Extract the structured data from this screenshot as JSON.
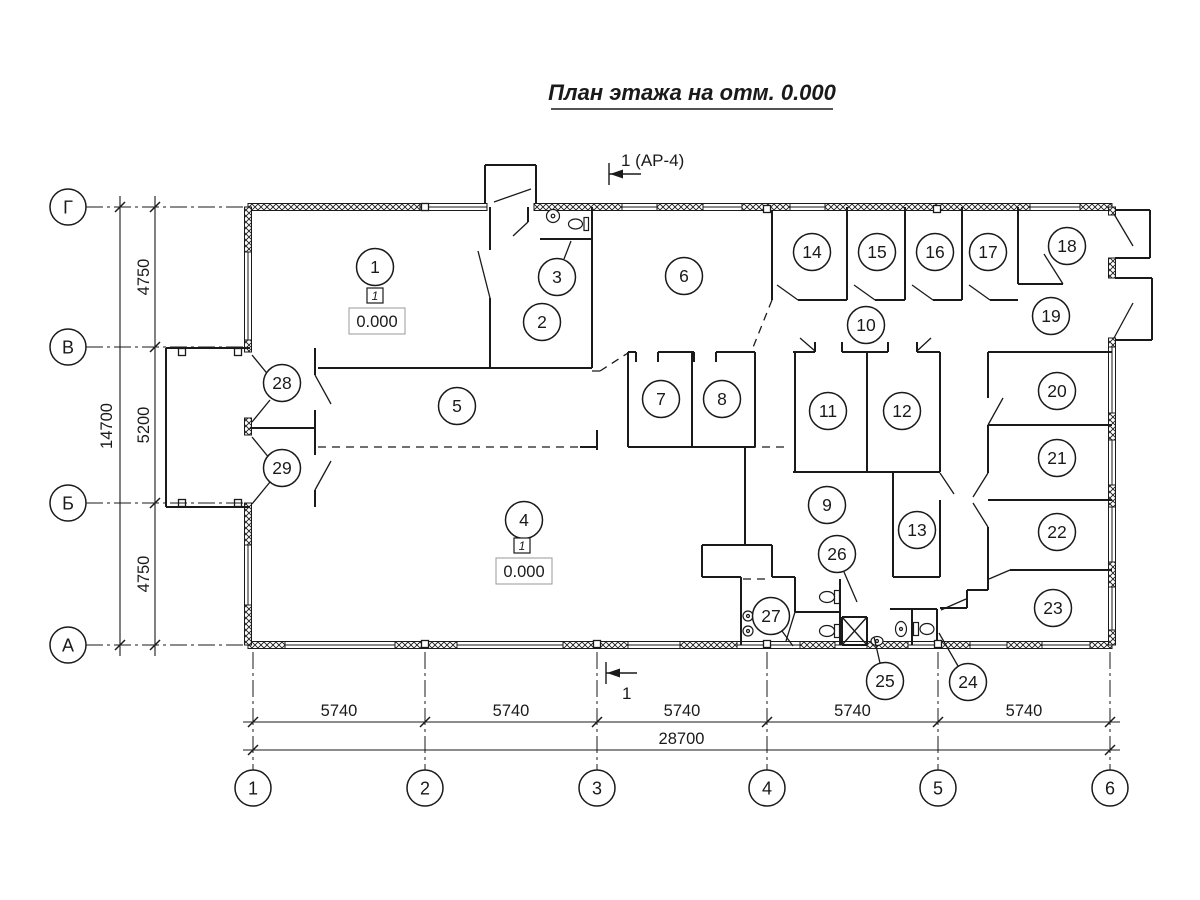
{
  "title": "План этажа на отм. 0.000",
  "section_marks": {
    "top": "1 (АР-4)",
    "bottom": "1"
  },
  "axes": {
    "rows": [
      {
        "label": "Г",
        "y": 207
      },
      {
        "label": "В",
        "y": 347
      },
      {
        "label": "Б",
        "y": 503
      },
      {
        "label": "А",
        "y": 645
      }
    ],
    "cols": [
      {
        "label": "1",
        "x": 253
      },
      {
        "label": "2",
        "x": 425
      },
      {
        "label": "3",
        "x": 597
      },
      {
        "label": "4",
        "x": 767
      },
      {
        "label": "5",
        "x": 938
      },
      {
        "label": "6",
        "x": 1110
      }
    ]
  },
  "dimensions": {
    "left_segments": [
      "4750",
      "5200",
      "4750"
    ],
    "left_total": "14700",
    "bottom_segments": [
      "5740",
      "5740",
      "5740",
      "5740",
      "5740"
    ],
    "bottom_total": "28700"
  },
  "rooms": [
    {
      "n": "1",
      "x": 375,
      "y": 267
    },
    {
      "n": "2",
      "x": 542,
      "y": 322
    },
    {
      "n": "3",
      "x": 557,
      "y": 277
    },
    {
      "n": "4",
      "x": 524,
      "y": 520
    },
    {
      "n": "5",
      "x": 457,
      "y": 406
    },
    {
      "n": "6",
      "x": 684,
      "y": 276
    },
    {
      "n": "7",
      "x": 661,
      "y": 399
    },
    {
      "n": "8",
      "x": 722,
      "y": 399
    },
    {
      "n": "9",
      "x": 827,
      "y": 505
    },
    {
      "n": "10",
      "x": 866,
      "y": 325
    },
    {
      "n": "11",
      "x": 828,
      "y": 411
    },
    {
      "n": "12",
      "x": 902,
      "y": 411
    },
    {
      "n": "13",
      "x": 917,
      "y": 530
    },
    {
      "n": "14",
      "x": 812,
      "y": 252
    },
    {
      "n": "15",
      "x": 877,
      "y": 252
    },
    {
      "n": "16",
      "x": 935,
      "y": 252
    },
    {
      "n": "17",
      "x": 988,
      "y": 252
    },
    {
      "n": "18",
      "x": 1067,
      "y": 246
    },
    {
      "n": "19",
      "x": 1051,
      "y": 316
    },
    {
      "n": "20",
      "x": 1057,
      "y": 391
    },
    {
      "n": "21",
      "x": 1057,
      "y": 458
    },
    {
      "n": "22",
      "x": 1057,
      "y": 532
    },
    {
      "n": "23",
      "x": 1053,
      "y": 608
    },
    {
      "n": "24",
      "x": 968,
      "y": 682
    },
    {
      "n": "25",
      "x": 885,
      "y": 681
    },
    {
      "n": "26",
      "x": 837,
      "y": 554
    },
    {
      "n": "27",
      "x": 771,
      "y": 616
    },
    {
      "n": "28",
      "x": 282,
      "y": 383
    },
    {
      "n": "29",
      "x": 282,
      "y": 468
    }
  ],
  "elevations": [
    {
      "value": "0.000",
      "type": "1",
      "x": 377,
      "y": 321
    },
    {
      "value": "0.000",
      "type": "1",
      "x": 524,
      "y": 571
    }
  ],
  "colors": {
    "line": "#1a1a1a",
    "background": "#ffffff"
  }
}
